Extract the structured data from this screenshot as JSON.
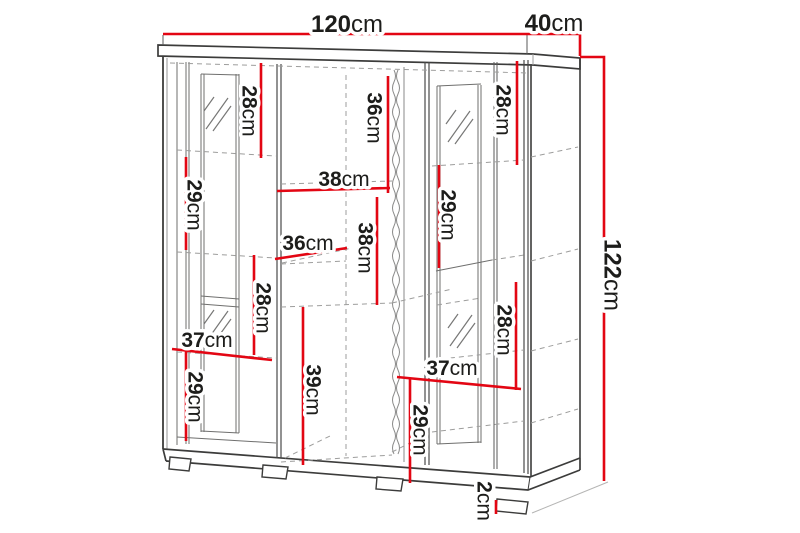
{
  "diagram": {
    "type": "furniture-dimension-diagram",
    "subject": "display cabinet with two glass doors, open middle shelves, top and base panels with feet",
    "unit": "cm"
  },
  "colors": {
    "dimension": "#e30613",
    "text": "#1d1d1b",
    "cabinet_dark": "#3c3c3b",
    "cabinet_mid": "#6f6f6e",
    "cabinet_light": "#9d9d9c",
    "background": "#ffffff"
  },
  "labels": [
    {
      "name": "top-width",
      "value": "120",
      "unit": "cm"
    },
    {
      "name": "top-depth",
      "value": "40",
      "unit": "cm"
    },
    {
      "name": "overall-height",
      "value": "122",
      "unit": "cm"
    },
    {
      "name": "left-top-niche-height",
      "value": "28",
      "unit": "cm"
    },
    {
      "name": "middle-top-niche-height",
      "value": "36",
      "unit": "cm"
    },
    {
      "name": "right-top-niche-height",
      "value": "28",
      "unit": "cm"
    },
    {
      "name": "left-upper-niche-height",
      "value": "29",
      "unit": "cm"
    },
    {
      "name": "middle-shelf-width",
      "value": "38",
      "unit": "cm"
    },
    {
      "name": "right-upper-niche-height",
      "value": "29",
      "unit": "cm"
    },
    {
      "name": "middle-shelf-depth",
      "value": "36",
      "unit": "cm"
    },
    {
      "name": "middle-lower-niche-height",
      "value": "38",
      "unit": "cm"
    },
    {
      "name": "left-lower-niche-height",
      "value": "28",
      "unit": "cm"
    },
    {
      "name": "left-door-width",
      "value": "37",
      "unit": "cm"
    },
    {
      "name": "left-bottom-niche-height",
      "value": "29",
      "unit": "cm"
    },
    {
      "name": "middle-bottom-niche-height",
      "value": "39",
      "unit": "cm"
    },
    {
      "name": "right-lower-niche-height",
      "value": "28",
      "unit": "cm"
    },
    {
      "name": "right-door-width",
      "value": "37",
      "unit": "cm"
    },
    {
      "name": "right-bottom-niche-height",
      "value": "29",
      "unit": "cm"
    },
    {
      "name": "foot-height",
      "value": "2",
      "unit": "cm"
    }
  ]
}
